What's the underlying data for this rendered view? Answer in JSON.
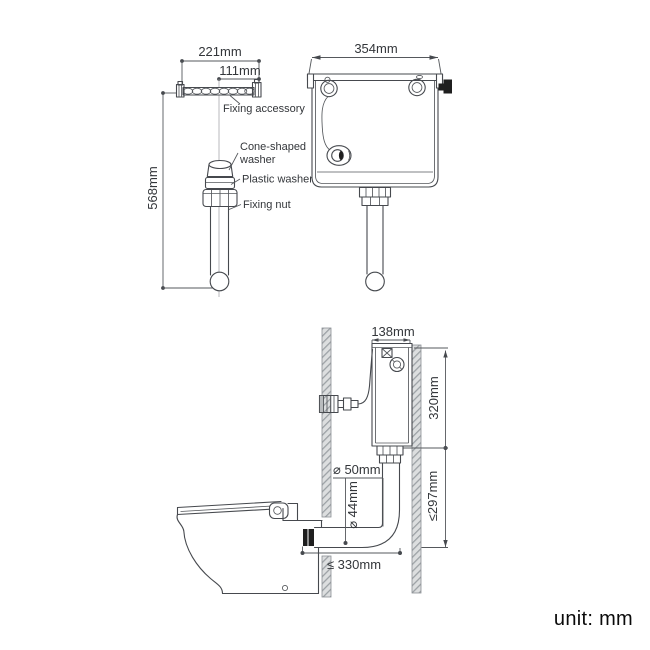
{
  "unit_note": {
    "label": "unit: mm"
  },
  "colors": {
    "line": "#46494e",
    "text": "#33363a",
    "wall_fill": "#dcdedf",
    "wall_hatch": "#9ba0a4",
    "connector_black": "#1f1f1f",
    "background": "#ffffff"
  },
  "fixing_accessory_view": {
    "rail_width_dim": "221mm",
    "hole_spacing_dim": "111mm",
    "drop_height_dim": "568mm",
    "labels": {
      "fixing_accessory": "Fixing accessory",
      "cone_washer_line1": "Cone-shaped",
      "cone_washer_line2": "washer",
      "plastic_washer": "Plastic washer",
      "fixing_nut": "Fixing nut"
    }
  },
  "cistern_front_view": {
    "width_dim": "354mm"
  },
  "installation_side_view": {
    "cistern_depth_dim": "138mm",
    "cistern_height_dim": "320mm",
    "flush_drop_dim": "≤297mm",
    "pipe_outer_diameter_dim": "⌀ 50mm",
    "pipe_inner_diameter_dim": "⌀ 44mm",
    "setout_dim": "≤ 330mm"
  }
}
